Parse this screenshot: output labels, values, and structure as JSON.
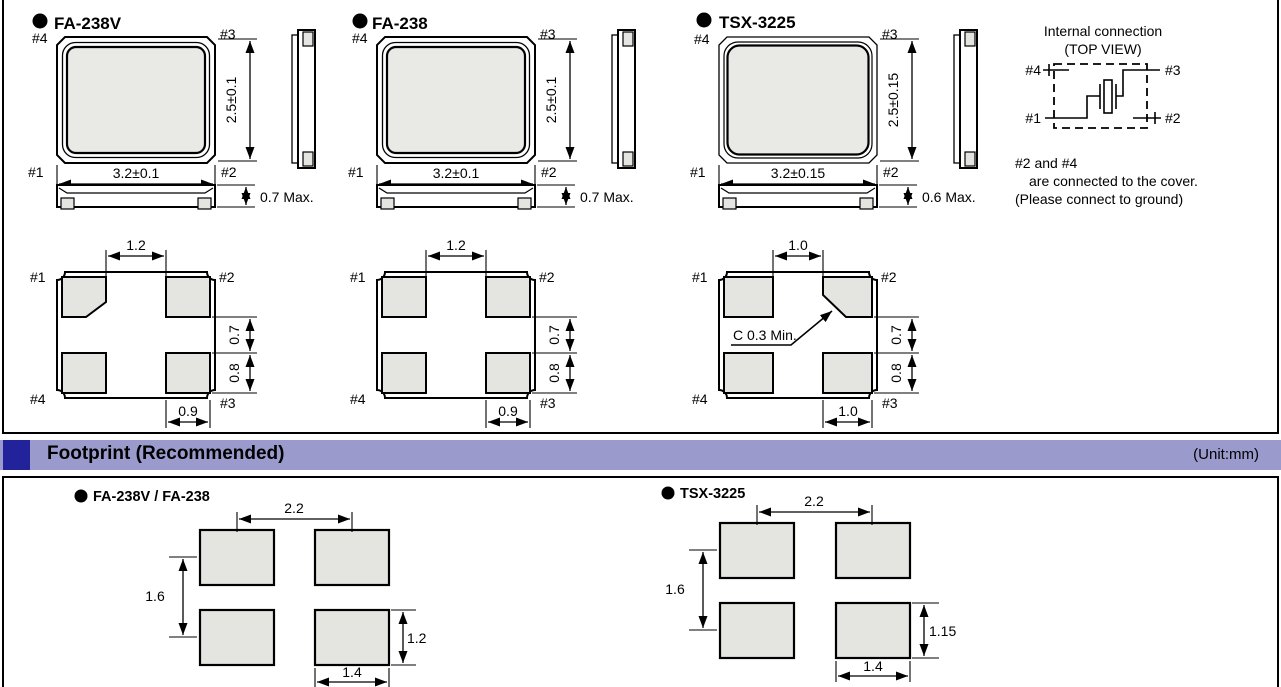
{
  "pin_labels": {
    "p1": "#1",
    "p2": "#2",
    "p3": "#3",
    "p4": "#4"
  },
  "packages": [
    {
      "title": "FA-238V",
      "width": "3.2±0.1",
      "height": "2.5±0.1",
      "thickness": "0.7 Max.",
      "pad_top": "1.2",
      "pad_gap": "0.7",
      "pad_h": "0.8",
      "pad_w": "0.9"
    },
    {
      "title": "FA-238",
      "width": "3.2±0.1",
      "height": "2.5±0.1",
      "thickness": "0.7 Max.",
      "pad_top": "1.2",
      "pad_gap": "0.7",
      "pad_h": "0.8",
      "pad_w": "0.9"
    },
    {
      "title": "TSX-3225",
      "width": "3.2±0.15",
      "height": "2.5±0.15",
      "thickness": "0.6 Max.",
      "pad_top": "1.0",
      "pad_gap": "0.7",
      "pad_h": "0.8",
      "pad_w": "1.0",
      "chamfer_note": "C 0.3 Min."
    }
  ],
  "internal_connection": {
    "title_line1": "Internal connection",
    "title_line2": "(TOP VIEW)",
    "note_line1": "#2 and #4",
    "note_line2": "are connected to the cover.",
    "note_line3": "(Please connect to ground)"
  },
  "footprint": {
    "header": "Footprint (Recommended)",
    "unit": "(Unit:mm)",
    "items": [
      {
        "title": "FA-238V / FA-238",
        "h_pitch": "2.2",
        "v_pitch": "1.6",
        "pad_height": "1.2",
        "pad_width": "1.4"
      },
      {
        "title": "TSX-3225",
        "h_pitch": "2.2",
        "v_pitch": "1.6",
        "pad_height": "1.15",
        "pad_width": "1.4"
      }
    ]
  },
  "colors": {
    "bar_bg": "#9a9acd",
    "bar_accent": "#22229a",
    "pad_fill": "#e4e4e1",
    "crystal_fill": "#e9e9e6"
  }
}
